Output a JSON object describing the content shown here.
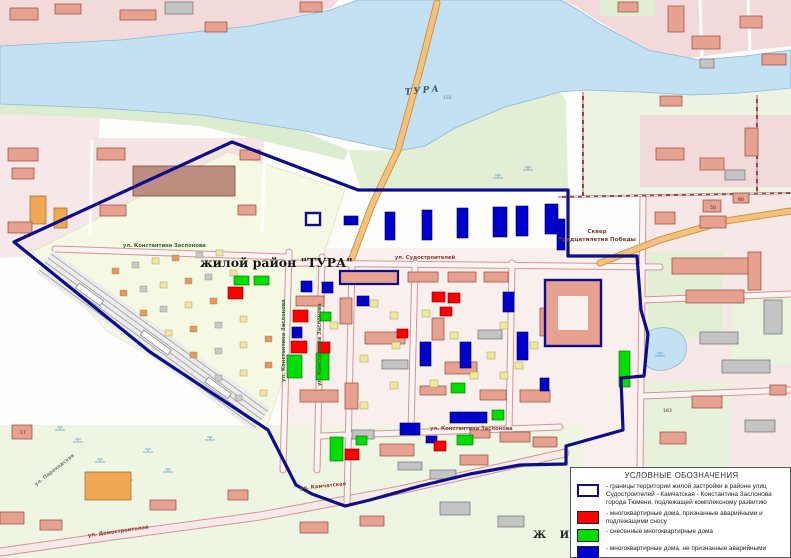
{
  "map": {
    "labels": {
      "district_title": "жилой район \"ТУРА\"",
      "river": "ТУРА",
      "river_note": "150",
      "street_zaslonova_top": "ул. Константина Заслонова",
      "street_sudostroiteley": "ул. Судостроителей",
      "street_zaslonova_v1": "ул. Константина Заслонова",
      "street_zaslonova_v2": "ул. Константина Заслонова",
      "street_zaslonova_bottom": "ул. Константина Заслонова",
      "street_kamchatskaya": "ул. Камчатская",
      "street_domostroiteley": "ул. Домостроителей",
      "street_parohodskaya": "ул. Пароходская",
      "square_line1": "Сквер",
      "square_line2": "Тридцатилетия Победы",
      "zhil": "Ж  И  Л"
    },
    "building_numbers": [
      {
        "n": "17",
        "x": 20,
        "y": 434
      },
      {
        "n": "50",
        "x": 710,
        "y": 209
      },
      {
        "n": "90",
        "x": 738,
        "y": 201
      },
      {
        "n": "183",
        "x": 663,
        "y": 412
      }
    ],
    "colors": {
      "boundary": "#0d0d8c",
      "red": "#ff0000",
      "green": "#00dd00",
      "blue": "#0000cc",
      "water": "#c3e1f2"
    },
    "houses": {
      "red": [
        [
          228,
          287,
          15,
          12
        ],
        [
          293,
          310,
          15,
          12
        ],
        [
          291,
          341,
          16,
          12
        ],
        [
          318,
          342,
          12,
          11
        ],
        [
          432,
          292,
          13,
          10
        ],
        [
          448,
          293,
          12,
          10
        ],
        [
          440,
          307,
          12,
          9
        ],
        [
          397,
          329,
          11,
          9
        ],
        [
          345,
          449,
          14,
          11
        ],
        [
          434,
          441,
          12,
          10
        ]
      ],
      "green": [
        [
          234,
          276,
          15,
          9
        ],
        [
          254,
          276,
          15,
          9
        ],
        [
          320,
          312,
          11,
          9
        ],
        [
          287,
          355,
          15,
          23
        ],
        [
          316,
          353,
          13,
          27
        ],
        [
          619,
          351,
          11,
          36
        ],
        [
          330,
          437,
          13,
          24
        ],
        [
          356,
          436,
          11,
          9
        ],
        [
          457,
          435,
          16,
          10
        ],
        [
          451,
          383,
          14,
          10
        ],
        [
          492,
          410,
          12,
          10
        ]
      ],
      "blue": [
        [
          385,
          212,
          10,
          28
        ],
        [
          422,
          210,
          10,
          30
        ],
        [
          457,
          208,
          11,
          30
        ],
        [
          493,
          207,
          14,
          30
        ],
        [
          516,
          206,
          12,
          30
        ],
        [
          545,
          204,
          13,
          30
        ],
        [
          344,
          216,
          14,
          9
        ],
        [
          557,
          219,
          8,
          31
        ],
        [
          301,
          281,
          11,
          11
        ],
        [
          322,
          282,
          11,
          11
        ],
        [
          292,
          327,
          10,
          11
        ],
        [
          357,
          296,
          12,
          10
        ],
        [
          503,
          292,
          11,
          20
        ],
        [
          517,
          332,
          11,
          28
        ],
        [
          420,
          342,
          11,
          24
        ],
        [
          460,
          342,
          11,
          26
        ],
        [
          450,
          412,
          37,
          11
        ],
        [
          400,
          423,
          20,
          12
        ],
        [
          426,
          436,
          11,
          7
        ],
        [
          540,
          378,
          9,
          13
        ]
      ]
    },
    "legend": {
      "title": "УСЛОВНЫЕ ОБОЗНАЧЕНИЯ",
      "items": [
        {
          "swatch": "boundary",
          "text": "- границы территории жилой застройки в районе улиц Судостроителей - Камчатская - Константина Заслонова города Тюмени, подлежащей комплексному развитию"
        },
        {
          "swatch": "red",
          "text": "- многоквартирные дома, признанные аварийными и подлежащими сносу"
        },
        {
          "swatch": "green",
          "text": "- снесенные многоквартирные дома"
        },
        {
          "swatch": "blue",
          "text": "- многоквартирные дома, не признанные аварийными"
        }
      ]
    }
  }
}
